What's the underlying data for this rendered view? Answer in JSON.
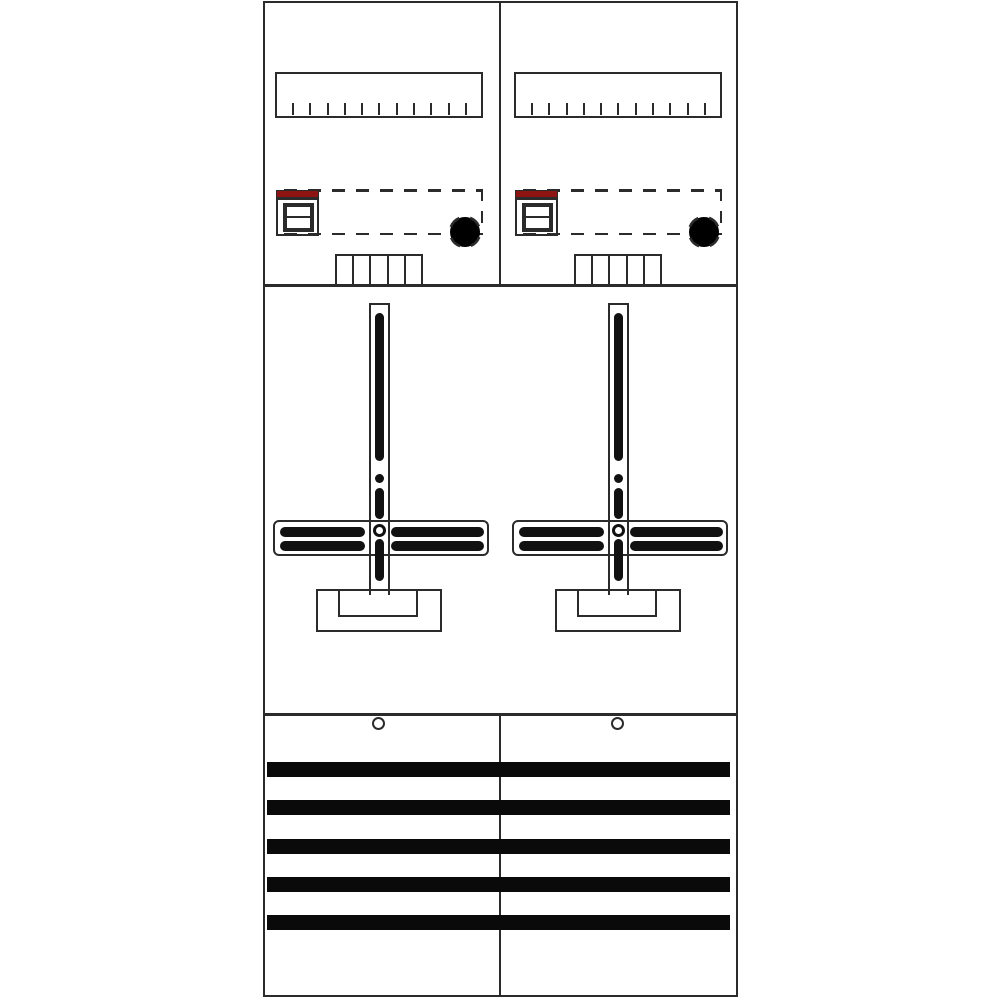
{
  "document": {
    "kind": "technical-line-drawing",
    "subject": "two-field electricity meter panel layout drawing",
    "orientation": "portrait",
    "visible_text": ""
  },
  "colors": {
    "background": "#ffffff",
    "line": "#2b2b2b",
    "slot": "#111111",
    "busbar": "#0a0a0a",
    "red": "#8e1414"
  },
  "panel": {
    "field_count": 2,
    "top_section": {
      "ruler_tick_count": 11,
      "comb_cell_count": 5,
      "device_marking_color": "#8e1414"
    },
    "middle_section": {
      "mounting_cross_count": 2,
      "arm_slot_count": 4
    },
    "bottom_section": {
      "busbar_count": 5,
      "screw_hole_count": 2
    }
  },
  "component_names": {
    "ruler": "din-rail-scale",
    "device": "main-switch-device-with-red-marking",
    "reserved_area": "dashed-reserved-device-area",
    "knockout": "dashed-knockout-circle",
    "comb": "wiring-comb",
    "cross": "meter-mounting-cross",
    "bracket": "meter-fixing-bracket",
    "busbar": "busbar",
    "screw_hole": "fixing-screw-hole"
  }
}
